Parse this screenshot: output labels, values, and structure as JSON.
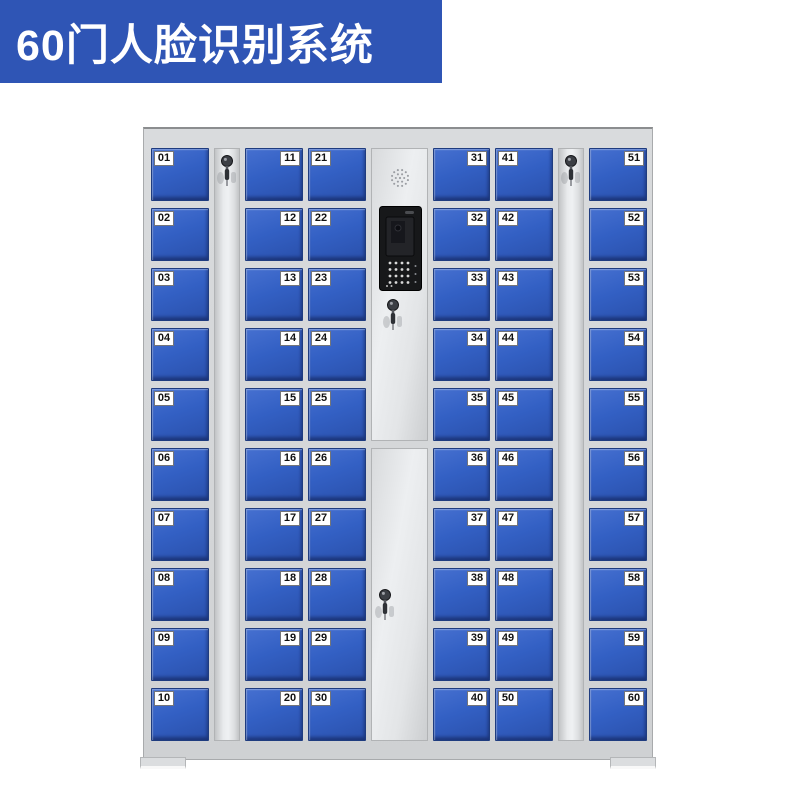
{
  "banner": {
    "title": "60门人脸识别系统",
    "bg_color": "#2f55b5",
    "text_color": "#ffffff"
  },
  "cabinet": {
    "body_color": "#d5d7d9",
    "door_color": "#3360c4",
    "door_border_color": "#1f3c7f",
    "door_label_bg": "#ffffff",
    "door_label_text": "#111111",
    "total_doors": 60,
    "icons": {
      "strip_lock": "key-lock-icon",
      "control_speaker": "speaker-grille-icon",
      "control_screen": "face-recognition-screen",
      "control_keypad": "keypad-dots-icon",
      "control_locks": "key-lock-icon"
    },
    "columns": [
      {
        "name": "door-column-1",
        "type": "doors",
        "label_side": "left",
        "doors": [
          "01",
          "02",
          "03",
          "04",
          "05",
          "06",
          "07",
          "08",
          "09",
          "10"
        ]
      },
      {
        "name": "lock-strip-1",
        "type": "strip"
      },
      {
        "name": "door-column-2",
        "type": "doors",
        "label_side": "right",
        "doors": [
          "11",
          "12",
          "13",
          "14",
          "15",
          "16",
          "17",
          "18",
          "19",
          "20"
        ]
      },
      {
        "name": "door-column-3",
        "type": "doors",
        "label_side": "left",
        "narrow": false,
        "doors": [
          "21",
          "22",
          "23",
          "24",
          "25",
          "26",
          "27",
          "28",
          "29",
          "30"
        ]
      },
      {
        "name": "control-column",
        "type": "control"
      },
      {
        "name": "door-column-4",
        "type": "doors",
        "label_side": "right",
        "narrow": true,
        "doors": [
          "31",
          "32",
          "33",
          "34",
          "35",
          "36",
          "37",
          "38",
          "39",
          "40"
        ]
      },
      {
        "name": "door-column-5",
        "type": "doors",
        "label_side": "left",
        "doors": [
          "41",
          "42",
          "43",
          "44",
          "45",
          "46",
          "47",
          "48",
          "49",
          "50"
        ]
      },
      {
        "name": "lock-strip-2",
        "type": "strip"
      },
      {
        "name": "door-column-6",
        "type": "doors",
        "label_side": "right",
        "doors": [
          "51",
          "52",
          "53",
          "54",
          "55",
          "56",
          "57",
          "58",
          "59",
          "60"
        ]
      }
    ]
  }
}
